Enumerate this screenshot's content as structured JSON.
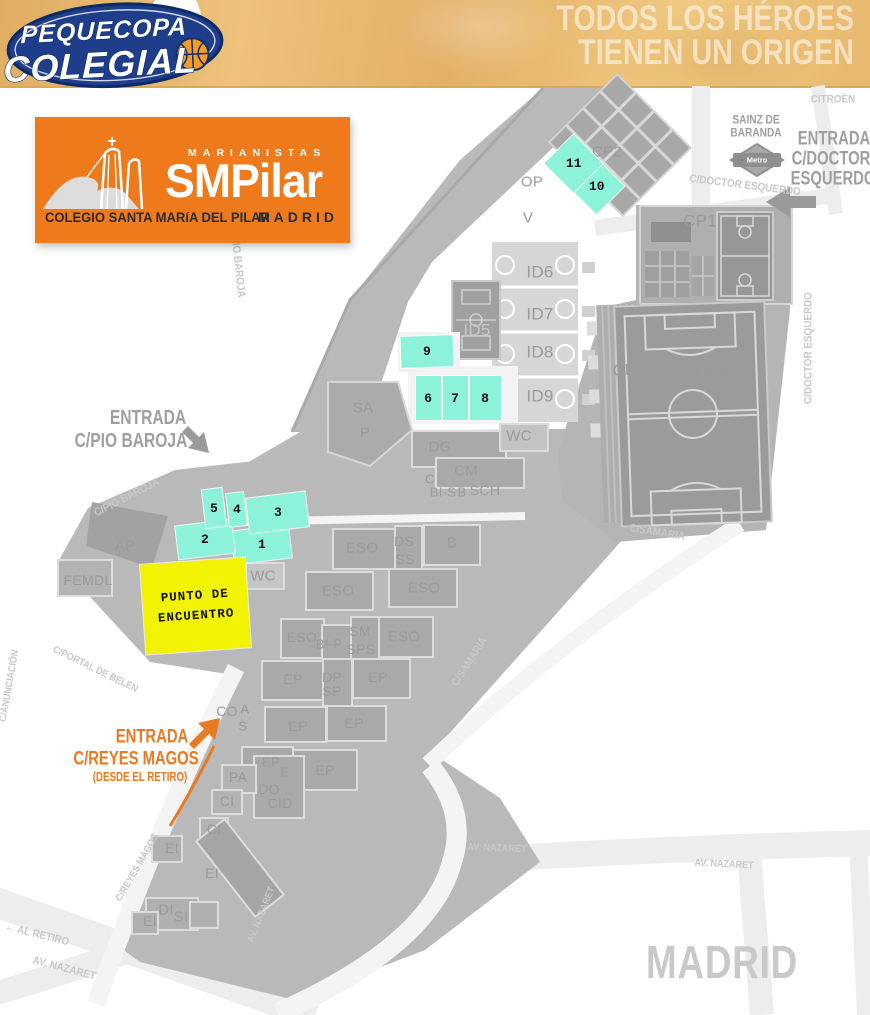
{
  "banner": {
    "logo_line1": "PEQUECOPA",
    "logo_line2": "COLEGIAL",
    "tagline_line1": "TODOS LOS HÉROES",
    "tagline_line2": "TIENEN UN ORIGEN"
  },
  "school_logo": {
    "brand_small": "MARIANISTAS",
    "brand_large": "SMPilar",
    "subtitle": "COLEGIO SANTA MARíA DEL PILAR",
    "city": "MADRID"
  },
  "colors": {
    "logo_orange": "#EE7A1B",
    "entrance_orange": "#E87A22",
    "court_cyan": "#8CF2DA",
    "meeting_yellow": "#F2F303",
    "campus_gray": "#B9B9B9",
    "logo_blue": "#1E3E8C"
  },
  "map": {
    "meeting_point": {
      "line1": "PUNTO  DE",
      "line2": "ENCUENTRO"
    },
    "courts": [
      {
        "n": "1",
        "x": 261,
        "y": 544,
        "w": 57,
        "h": 33,
        "r": -7
      },
      {
        "n": "2",
        "x": 205,
        "y": 539,
        "w": 56,
        "h": 33,
        "r": -7
      },
      {
        "n": "3",
        "x": 277,
        "y": 512,
        "w": 59,
        "h": 35,
        "r": -7
      },
      {
        "n": "4",
        "x": 236,
        "y": 509,
        "w": 17,
        "h": 33,
        "r": -7
      },
      {
        "n": "5",
        "x": 214,
        "y": 508,
        "w": 20,
        "h": 38,
        "r": -7
      },
      {
        "n": "6",
        "x": 428,
        "y": 398,
        "w": 25,
        "h": 44,
        "r": 0
      },
      {
        "n": "7",
        "x": 455,
        "y": 398,
        "w": 25,
        "h": 44,
        "r": 0
      },
      {
        "n": "8",
        "x": 485,
        "y": 398,
        "w": 31,
        "h": 44,
        "r": 0
      },
      {
        "n": "9",
        "x": 427,
        "y": 351,
        "w": 52,
        "h": 31,
        "r": -2
      },
      {
        "n": "10",
        "x": 596,
        "y": 186,
        "w": 39,
        "h": 39,
        "r": 45
      },
      {
        "n": "11",
        "x": 573,
        "y": 163,
        "w": 41,
        "h": 41,
        "r": 45
      }
    ],
    "labels": [
      {
        "t": "CP2",
        "x": 607,
        "y": 152,
        "c": "bldg",
        "s": 15
      },
      {
        "t": "OP",
        "x": 532,
        "y": 182,
        "c": "bldg",
        "s": 15
      },
      {
        "t": "V",
        "x": 528,
        "y": 218,
        "c": "bldg",
        "s": 15
      },
      {
        "t": "CP1",
        "x": 700,
        "y": 221,
        "c": "bldg",
        "s": 17
      },
      {
        "t": "ID6",
        "x": 540,
        "y": 272,
        "c": "bldg",
        "s": 17
      },
      {
        "t": "ID7",
        "x": 540,
        "y": 314,
        "c": "bldg",
        "s": 17
      },
      {
        "t": "ID5",
        "x": 477,
        "y": 330,
        "c": "bldg-lt",
        "s": 17
      },
      {
        "t": "ID8",
        "x": 540,
        "y": 352,
        "c": "bldg",
        "s": 17
      },
      {
        "t": "ID9",
        "x": 540,
        "y": 396,
        "c": "bldg",
        "s": 17
      },
      {
        "t": "CP4",
        "x": 629,
        "y": 371,
        "c": "bldg",
        "s": 16,
        "r": -4
      },
      {
        "t": "CP3",
        "x": 712,
        "y": 372,
        "c": "bldg",
        "s": 17
      },
      {
        "t": "SA",
        "x": 363,
        "y": 408,
        "c": "bldg",
        "s": 15
      },
      {
        "t": "P",
        "x": 365,
        "y": 433,
        "c": "bldg",
        "s": 15
      },
      {
        "t": "DG",
        "x": 440,
        "y": 447,
        "c": "bldg",
        "s": 15
      },
      {
        "t": "WC",
        "x": 519,
        "y": 436,
        "c": "bldg",
        "s": 15
      },
      {
        "t": "C",
        "x": 430,
        "y": 479,
        "c": "bldg",
        "s": 13
      },
      {
        "t": "CM",
        "x": 466,
        "y": 471,
        "c": "bldg",
        "s": 15
      },
      {
        "t": "BI-S",
        "x": 443,
        "y": 492,
        "c": "bldg",
        "s": 13
      },
      {
        "t": "B",
        "x": 462,
        "y": 492,
        "c": "bldg",
        "s": 13
      },
      {
        "t": "SCH",
        "x": 485,
        "y": 490,
        "c": "bldg",
        "s": 14
      },
      {
        "t": "AP",
        "x": 125,
        "y": 546,
        "c": "bldg",
        "s": 15
      },
      {
        "t": "FEMDL",
        "x": 88,
        "y": 580,
        "c": "bldg",
        "s": 14
      },
      {
        "t": "WC",
        "x": 263,
        "y": 576,
        "c": "bldg",
        "s": 15
      },
      {
        "t": "ESO",
        "x": 362,
        "y": 548,
        "c": "bldg",
        "s": 15
      },
      {
        "t": "DS",
        "x": 404,
        "y": 541,
        "c": "bldg",
        "s": 14
      },
      {
        "t": "SS",
        "x": 405,
        "y": 559,
        "c": "bldg",
        "s": 14
      },
      {
        "t": "B",
        "x": 452,
        "y": 543,
        "c": "bldg",
        "s": 15
      },
      {
        "t": "ESO",
        "x": 338,
        "y": 591,
        "c": "bldg",
        "s": 15
      },
      {
        "t": "ESO",
        "x": 424,
        "y": 588,
        "c": "bldg",
        "s": 15
      },
      {
        "t": "ESO",
        "x": 302,
        "y": 637,
        "c": "bldg",
        "s": 14
      },
      {
        "t": "BI-P",
        "x": 329,
        "y": 644,
        "c": "bldg",
        "s": 13
      },
      {
        "t": "SM",
        "x": 360,
        "y": 631,
        "c": "bldg",
        "s": 14
      },
      {
        "t": "SPS",
        "x": 361,
        "y": 649,
        "c": "bldg",
        "s": 14
      },
      {
        "t": "ESO",
        "x": 404,
        "y": 637,
        "c": "bldg",
        "s": 15
      },
      {
        "t": "EP",
        "x": 293,
        "y": 679,
        "c": "bldg",
        "s": 14
      },
      {
        "t": "DP",
        "x": 332,
        "y": 677,
        "c": "bldg",
        "s": 14
      },
      {
        "t": "SP",
        "x": 332,
        "y": 691,
        "c": "bldg",
        "s": 14
      },
      {
        "t": "EP",
        "x": 378,
        "y": 677,
        "c": "bldg",
        "s": 14
      },
      {
        "t": "CO",
        "x": 227,
        "y": 711,
        "c": "bldg",
        "s": 14
      },
      {
        "t": "A",
        "x": 245,
        "y": 709,
        "c": "bldg",
        "s": 13
      },
      {
        "t": "S",
        "x": 243,
        "y": 726,
        "c": "bldg",
        "s": 13
      },
      {
        "t": "EP",
        "x": 298,
        "y": 726,
        "c": "bldg",
        "s": 14
      },
      {
        "t": "EP",
        "x": 354,
        "y": 723,
        "c": "bldg",
        "s": 14
      },
      {
        "t": "EP",
        "x": 271,
        "y": 762,
        "c": "bldg",
        "s": 13
      },
      {
        "t": "E",
        "x": 285,
        "y": 772,
        "c": "bldg",
        "s": 13
      },
      {
        "t": "EP",
        "x": 325,
        "y": 770,
        "c": "bldg",
        "s": 14
      },
      {
        "t": "PA",
        "x": 238,
        "y": 777,
        "c": "bldg",
        "s": 14
      },
      {
        "t": "DO",
        "x": 269,
        "y": 789,
        "c": "bldg",
        "s": 14
      },
      {
        "t": "CID",
        "x": 280,
        "y": 803,
        "c": "bldg",
        "s": 14
      },
      {
        "t": "CI",
        "x": 227,
        "y": 801,
        "c": "bldg",
        "s": 14
      },
      {
        "t": "CI",
        "x": 214,
        "y": 829,
        "c": "bldg",
        "s": 14
      },
      {
        "t": "EI",
        "x": 172,
        "y": 848,
        "c": "bldg",
        "s": 14
      },
      {
        "t": "EI",
        "x": 212,
        "y": 873,
        "c": "bldg",
        "s": 14
      },
      {
        "t": "DI",
        "x": 166,
        "y": 910,
        "c": "bldg",
        "s": 15
      },
      {
        "t": "SI",
        "x": 181,
        "y": 917,
        "c": "bldg",
        "s": 15
      },
      {
        "t": "EI",
        "x": 150,
        "y": 921,
        "c": "bldg",
        "s": 14
      },
      {
        "t": "C/DOCTOR ESQUERDO",
        "x": 745,
        "y": 186,
        "c": "street",
        "s": 11,
        "r": 7
      },
      {
        "t": "C/DOCTOR ESQUERDO",
        "x": 809,
        "y": 348,
        "c": "street",
        "s": 11,
        "r": -90
      },
      {
        "t": "C/PIO BAROJA",
        "x": 237,
        "y": 262,
        "c": "street",
        "s": 11,
        "r": 84
      },
      {
        "t": "C/PIO BAROJA",
        "x": 127,
        "y": 498,
        "c": "street",
        "s": 11,
        "r": -27
      },
      {
        "t": "C/SAMARIA",
        "x": 657,
        "y": 533,
        "c": "street",
        "s": 11,
        "r": 9
      },
      {
        "t": "C/SAMARIA",
        "x": 470,
        "y": 662,
        "c": "street",
        "s": 11,
        "r": -57
      },
      {
        "t": "C/PORTAL DE BELEN",
        "x": 95,
        "y": 670,
        "c": "street",
        "s": 10,
        "r": 26
      },
      {
        "t": "C/ANUNCIACIÓN",
        "x": 10,
        "y": 686,
        "c": "street",
        "s": 10,
        "r": -80
      },
      {
        "t": "C/REYES MAGOS",
        "x": 138,
        "y": 868,
        "c": "street",
        "s": 10,
        "r": -60
      },
      {
        "t": "AV. NAZARET",
        "x": 262,
        "y": 915,
        "c": "street",
        "s": 10,
        "r": -68
      },
      {
        "t": "← AL RETIRO",
        "x": 37,
        "y": 935,
        "c": "street",
        "s": 11,
        "r": 14
      },
      {
        "t": "AV. NAZARET",
        "x": 64,
        "y": 969,
        "c": "street",
        "s": 11,
        "r": 15
      },
      {
        "t": "AV. NAZARET",
        "x": 497,
        "y": 849,
        "c": "street",
        "s": 10,
        "r": 2
      },
      {
        "t": "AV. NAZARET",
        "x": 724,
        "y": 865,
        "c": "street",
        "s": 10,
        "r": 3
      },
      {
        "t": "CITROËN",
        "x": 833,
        "y": 100,
        "c": "street",
        "s": 11
      },
      {
        "t": "SAINZ DE",
        "x": 756,
        "y": 121,
        "c": "station",
        "s": 11.5
      },
      {
        "t": "BARANDA",
        "x": 756,
        "y": 134,
        "c": "station",
        "s": 11.5
      },
      {
        "t": "Metro",
        "x": 757,
        "y": 160,
        "c": "metro",
        "s": 7.5
      },
      {
        "t": "ENTRADA",
        "x": 148,
        "y": 418,
        "c": "entrance",
        "s": 20
      },
      {
        "t": "C/PIO BAROJA",
        "x": 131,
        "y": 441,
        "c": "entrance",
        "s": 20
      },
      {
        "t": "ENTRADA",
        "x": 834,
        "y": 139,
        "c": "entrance",
        "s": 19
      },
      {
        "t": "C/DOCTOR",
        "x": 831,
        "y": 159,
        "c": "entrance",
        "s": 19
      },
      {
        "t": "ESQUERDO",
        "x": 833,
        "y": 179,
        "c": "entrance",
        "s": 19
      },
      {
        "t": "ENTRADA",
        "x": 152,
        "y": 737,
        "c": "entrance-o",
        "s": 19
      },
      {
        "t": "C/REYES MAGOS",
        "x": 136,
        "y": 759,
        "c": "entrance-o",
        "s": 19
      },
      {
        "t": "(DESDE EL RETIRO)",
        "x": 140,
        "y": 777,
        "c": "entrance-o",
        "s": 12.5
      },
      {
        "t": "MADRID",
        "x": 722,
        "y": 962,
        "c": "city",
        "s": 46
      }
    ]
  }
}
